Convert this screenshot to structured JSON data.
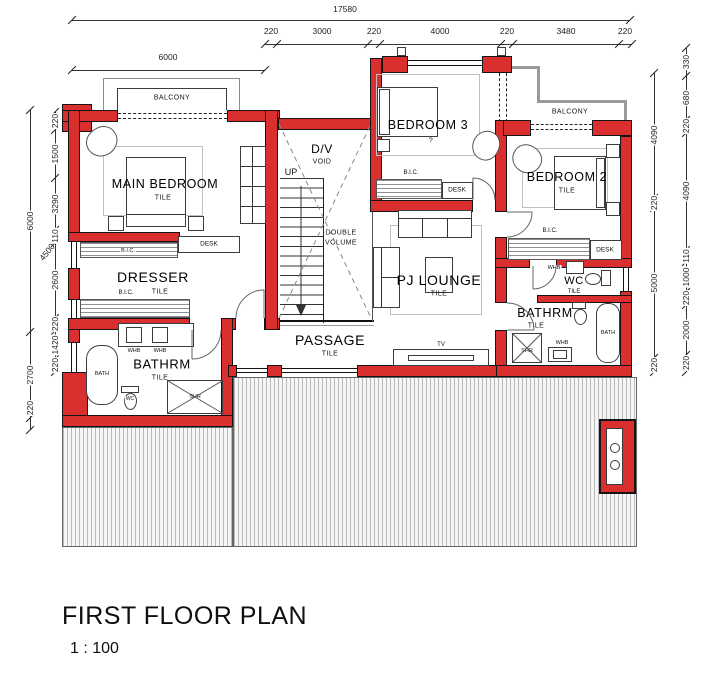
{
  "title": {
    "text": "FIRST FLOOR PLAN",
    "scale": "1 : 100"
  },
  "dimensions": {
    "overall_width": "17580",
    "upper_width": "6000",
    "top_chain": [
      "220",
      "3000",
      "220",
      "4000",
      "220",
      "3480",
      "220"
    ],
    "left_outer": [
      "6000",
      "2700",
      "220"
    ],
    "left_inner": [
      "220",
      "1500",
      "3290",
      "110",
      "2600",
      "220",
      "1420",
      "220"
    ],
    "left_diagonal": "4500",
    "right_inner": [
      "4090",
      "220",
      "5000",
      "220"
    ],
    "right_outer": [
      "330",
      "680",
      "220",
      "4090",
      "110",
      "1000",
      "220",
      "2000",
      "220"
    ]
  },
  "rooms": {
    "main_bedroom": {
      "name": "MAIN BEDROOM",
      "finish": "TILE"
    },
    "dresser": {
      "name": "DRESSER",
      "finish": "TILE"
    },
    "bathroom_left": {
      "name": "BATHRM",
      "finish": "TILE"
    },
    "bedroom3": {
      "name": "BEDROOM 3",
      "note": "?"
    },
    "bedroom2": {
      "name": "BEDROOM 2",
      "finish": "TILE"
    },
    "pj_lounge": {
      "name": "PJ LOUNGE",
      "finish": "TILE"
    },
    "passage": {
      "name": "PASSAGE",
      "finish": "TILE"
    },
    "wc_room": {
      "name": "WC",
      "finish": "TILE"
    },
    "bathroom_right": {
      "name": "BATHRM",
      "finish": "TILE"
    },
    "void": {
      "line1": "D/V",
      "line2": "VOID"
    },
    "double_volume": {
      "line1": "DOUBLE",
      "line2": "VOLUME"
    },
    "stairs": {
      "direction": "UP"
    },
    "balcony_main": {
      "name": "BALCONY"
    },
    "balcony_bedroom2": {
      "name": "BALCONY"
    }
  },
  "fixtures": {
    "bic": "B.I.C.",
    "desk": "DESK",
    "whb": "WHB",
    "bath": "BATH",
    "shower": "SHR",
    "toilet": "WC",
    "tv": "TV"
  }
}
